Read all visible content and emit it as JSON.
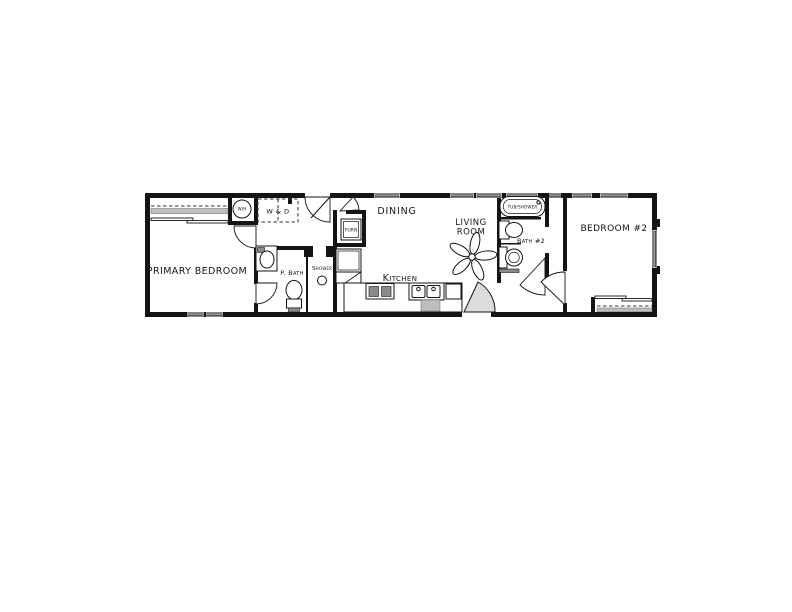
{
  "document": {
    "type": "floor-plan"
  },
  "rooms": {
    "primary_bedroom": "PRIMARY BEDROOM",
    "dining": "DINING",
    "kitchen": "Kitchen",
    "living_room": {
      "line1": "LIVING",
      "line2": "ROOM"
    },
    "bedroom_2": "BEDROOM #2",
    "primary_bath": "P. Bath",
    "shower": "Shower",
    "bath_2": "Bath #2"
  },
  "fixtures": {
    "water_heater": "W/H",
    "washer_dryer": "W & D",
    "furnace": "FURN",
    "tub_shower": "TUB/SHOWER"
  },
  "colors": {
    "wall": "#141414",
    "window_glass": "#9a9a9a",
    "door_shade": "#dcdcdc"
  }
}
